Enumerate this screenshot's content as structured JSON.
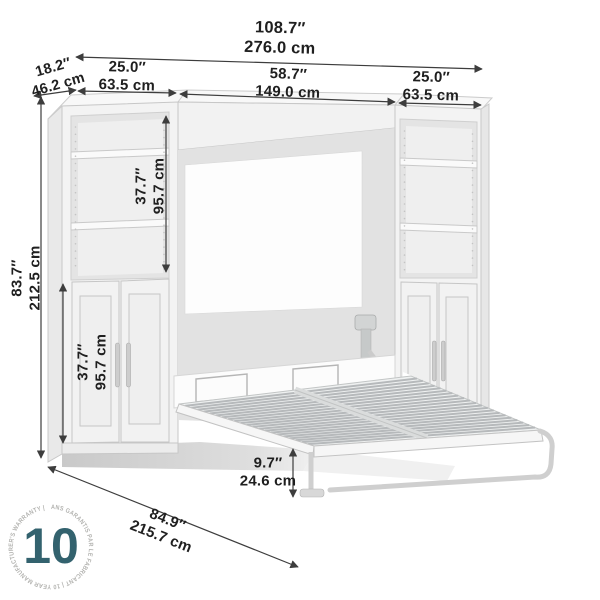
{
  "dimensions": [
    {
      "id": "overall_width",
      "in": "108.7″",
      "cm": "276.0 cm"
    },
    {
      "id": "depth",
      "in": "18.2″",
      "cm": "46.2 cm"
    },
    {
      "id": "left_tower_width",
      "in": "25.0″",
      "cm": "63.5 cm"
    },
    {
      "id": "bed_section_width",
      "in": "58.7″",
      "cm": "149.0 cm"
    },
    {
      "id": "right_tower_width",
      "in": "25.0″",
      "cm": "63.5 cm"
    },
    {
      "id": "overall_height",
      "in": "83.7″",
      "cm": "212.5 cm"
    },
    {
      "id": "upper_section_height",
      "in": "37.7″",
      "cm": "95.7 cm"
    },
    {
      "id": "lower_section_height",
      "in": "37.7″",
      "cm": "95.7 cm"
    },
    {
      "id": "bed_clearance_height",
      "in": "9.7″",
      "cm": "24.6 cm"
    },
    {
      "id": "open_bed_depth",
      "in": "84.9″",
      "cm": "215.7 cm"
    }
  ],
  "badge": {
    "number": "10",
    "ring_text": "ANS GARANTIS PAR LE FABRICANT  |  10 YEAR MANUFACTURER'S WARRANTY  |",
    "number_color": "#33626e",
    "ring_color": "#b3b3b0"
  },
  "colors": {
    "dimension_line": "#3d3d3d",
    "text": "#1f1f1f",
    "furniture_fill": "#f3f3f3",
    "furniture_stroke": "#c7c7c7"
  }
}
